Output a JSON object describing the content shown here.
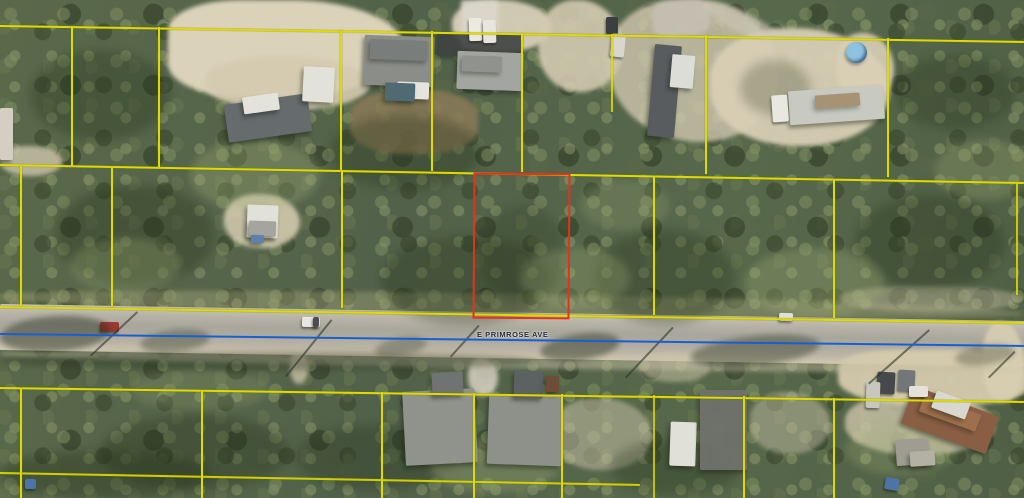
{
  "road": {
    "label": "E PRIMROSE AVE",
    "label_x": 477,
    "label_y": 331,
    "surface": {
      "x": 0,
      "y": 304,
      "w": 1040,
      "h": 46,
      "rot": 0.95
    },
    "centerline": {
      "x1": 0,
      "y1": 333,
      "x2": 1024,
      "y2": 345,
      "t": 2.4,
      "color": "#1a5fd0"
    }
  },
  "overlay": {
    "parcel_line_color": "#dedb04",
    "highlight_color": "#e8301a",
    "highlight_parcel": {
      "x": 473,
      "y": 173,
      "w": 93,
      "h": 142,
      "rot": 0.4
    },
    "parcel_lines": [
      {
        "x1": 0,
        "y1": 25,
        "x2": 1024,
        "y2": 41
      },
      {
        "x1": 0,
        "y1": 164,
        "x2": 1024,
        "y2": 182
      },
      {
        "x1": 0,
        "y1": 306,
        "x2": 1024,
        "y2": 322
      },
      {
        "x1": 0,
        "y1": 387,
        "x2": 1024,
        "y2": 401
      },
      {
        "x1": 0,
        "y1": 472,
        "x2": 640,
        "y2": 484,
        "op": 0.9
      },
      {
        "x1": 73,
        "y1": 26,
        "x2": 73,
        "y2": 166
      },
      {
        "x1": 160,
        "y1": 27,
        "x2": 160,
        "y2": 167
      },
      {
        "x1": 342,
        "y1": 30,
        "x2": 342,
        "y2": 170
      },
      {
        "x1": 433,
        "y1": 31,
        "x2": 433,
        "y2": 171
      },
      {
        "x1": 523,
        "y1": 33,
        "x2": 523,
        "y2": 172
      },
      {
        "x1": 613,
        "y1": 34,
        "x2": 613,
        "y2": 112,
        "op": 0.85
      },
      {
        "x1": 707,
        "y1": 35,
        "x2": 707,
        "y2": 174
      },
      {
        "x1": 889,
        "y1": 38,
        "x2": 889,
        "y2": 177
      },
      {
        "x1": 22,
        "y1": 166,
        "x2": 22,
        "y2": 306
      },
      {
        "x1": 113,
        "y1": 167,
        "x2": 113,
        "y2": 306
      },
      {
        "x1": 343,
        "y1": 170,
        "x2": 343,
        "y2": 308
      },
      {
        "x1": 655,
        "y1": 176,
        "x2": 655,
        "y2": 315
      },
      {
        "x1": 835,
        "y1": 179,
        "x2": 835,
        "y2": 318
      },
      {
        "x1": 1018,
        "y1": 183,
        "x2": 1018,
        "y2": 295,
        "op": 0.85
      },
      {
        "x1": 22,
        "y1": 388,
        "x2": 22,
        "y2": 498
      },
      {
        "x1": 203,
        "y1": 390,
        "x2": 203,
        "y2": 498
      },
      {
        "x1": 383,
        "y1": 392,
        "x2": 383,
        "y2": 498
      },
      {
        "x1": 475,
        "y1": 393,
        "x2": 475,
        "y2": 498
      },
      {
        "x1": 563,
        "y1": 394,
        "x2": 563,
        "y2": 498
      },
      {
        "x1": 655,
        "y1": 395,
        "x2": 655,
        "y2": 498,
        "op": 0.8
      },
      {
        "x1": 745,
        "y1": 396,
        "x2": 745,
        "y2": 498
      },
      {
        "x1": 835,
        "y1": 398,
        "x2": 835,
        "y2": 498
      }
    ]
  },
  "terrain": {
    "sand": [
      {
        "name": "sand-clearing",
        "x": 168,
        "y": 0,
        "w": 235,
        "h": 98,
        "color": "#dbd2ba",
        "br": "35% 55% 60% 40%"
      },
      {
        "name": "sand-clearing",
        "x": 205,
        "y": 56,
        "w": 165,
        "h": 54,
        "color": "#d5cbb1",
        "op": 0.9
      },
      {
        "name": "sand-clearing",
        "x": 452,
        "y": 0,
        "w": 100,
        "h": 52,
        "color": "#d7cfb8",
        "op": 0.95
      },
      {
        "name": "sand-clearing",
        "x": 538,
        "y": 0,
        "w": 85,
        "h": 92,
        "color": "#d3cab0",
        "op": 0.9
      },
      {
        "name": "sand-clearing",
        "x": 608,
        "y": 0,
        "w": 170,
        "h": 142,
        "color": "#cfc7ae",
        "op": 0.8,
        "br": "40% 50% 45% 55%"
      },
      {
        "name": "sand-clearing",
        "x": 710,
        "y": 28,
        "w": 180,
        "h": 118,
        "color": "#d8cfb5",
        "op": 0.95
      },
      {
        "name": "sand-clearing",
        "x": 836,
        "y": 33,
        "w": 58,
        "h": 70,
        "color": "#d9d0b6",
        "op": 0.9
      },
      {
        "name": "sand-trail",
        "x": 0,
        "y": 146,
        "w": 62,
        "h": 30,
        "color": "#cec5ab",
        "op": 0.8
      },
      {
        "name": "sand-clearing",
        "x": 224,
        "y": 194,
        "w": 76,
        "h": 54,
        "color": "#d2c9ae",
        "op": 0.9
      },
      {
        "name": "sand-clearing",
        "x": 838,
        "y": 350,
        "w": 190,
        "h": 55,
        "color": "#d5cbae",
        "op": 0.95,
        "br": "30% 40% 35% 45%"
      },
      {
        "name": "sand-clearing",
        "x": 982,
        "y": 322,
        "w": 42,
        "h": 80,
        "color": "#d8cfb3",
        "op": 0.9
      },
      {
        "name": "sand-clearing",
        "x": 552,
        "y": 398,
        "w": 100,
        "h": 72,
        "color": "#cfc7ac",
        "op": 0.5
      },
      {
        "name": "sand-clearing",
        "x": 750,
        "y": 392,
        "w": 80,
        "h": 62,
        "color": "#ccc4a9",
        "op": 0.45
      },
      {
        "name": "sand-clearing",
        "x": 640,
        "y": 352,
        "w": 70,
        "h": 30,
        "color": "#cdc5aa",
        "op": 0.5
      },
      {
        "name": "sand-clearing",
        "x": 845,
        "y": 393,
        "w": 150,
        "h": 62,
        "color": "#d4cbb0",
        "op": 0.75
      },
      {
        "name": "driveway",
        "x": 290,
        "y": 350,
        "w": 18,
        "h": 34,
        "color": "#cfc6ab",
        "op": 0.75
      },
      {
        "name": "driveway",
        "x": 468,
        "y": 358,
        "w": 30,
        "h": 38,
        "color": "#d6d0c2",
        "op": 0.85
      },
      {
        "name": "driveway",
        "x": 461,
        "y": 0,
        "w": 37,
        "h": 48,
        "color": "#dcd7cb",
        "op": 0.95,
        "br": "8%"
      },
      {
        "name": "dirt-yard",
        "x": 350,
        "y": 90,
        "w": 128,
        "h": 64,
        "color": "#8d7b58",
        "op": 0.8,
        "br": "40%"
      },
      {
        "name": "road-shoulder",
        "x": 0,
        "y": 286,
        "w": 1024,
        "h": 22,
        "color": "#aca97f",
        "op": 0.38,
        "rot": 0.9,
        "origin0": true
      },
      {
        "name": "road-shoulder",
        "x": 0,
        "y": 348,
        "w": 1024,
        "h": 12,
        "color": "#c8bfa4",
        "op": 0.5,
        "rot": 0.9,
        "origin0": true
      },
      {
        "name": "gravel-path",
        "x": 652,
        "y": 0,
        "w": 58,
        "h": 36,
        "color": "#c6c0b4",
        "op": 0.9,
        "rot": -6,
        "br": "30%"
      },
      {
        "name": "gravel-path",
        "x": 700,
        "y": 12,
        "w": 85,
        "h": 20,
        "color": "#cfc8b8",
        "op": 0.6,
        "rot": 25
      },
      {
        "name": "grass-strip",
        "x": 840,
        "y": 286,
        "w": 184,
        "h": 26,
        "color": "#b7b194",
        "op": 0.5
      }
    ],
    "canopy_dark": [
      {
        "x": 30,
        "y": 50,
        "w": 140,
        "h": 90,
        "op": 0.3
      },
      {
        "x": 330,
        "y": 115,
        "w": 150,
        "h": 75,
        "op": 0.3
      },
      {
        "x": 55,
        "y": 185,
        "w": 160,
        "h": 100,
        "op": 0.32
      },
      {
        "x": 380,
        "y": 235,
        "w": 170,
        "h": 90,
        "op": 0.3
      },
      {
        "x": 595,
        "y": 230,
        "w": 140,
        "h": 95,
        "op": 0.3
      },
      {
        "x": 855,
        "y": 195,
        "w": 150,
        "h": 95,
        "op": 0.3
      },
      {
        "x": 100,
        "y": 415,
        "w": 190,
        "h": 75,
        "op": 0.32
      },
      {
        "x": 295,
        "y": 425,
        "w": 160,
        "h": 65,
        "op": 0.3
      },
      {
        "x": 610,
        "y": 440,
        "w": 130,
        "h": 55,
        "op": 0.3
      },
      {
        "x": 895,
        "y": 55,
        "w": 120,
        "h": 75,
        "op": 0.28
      },
      {
        "x": 0,
        "y": 450,
        "w": 210,
        "h": 48,
        "op": 0.35
      },
      {
        "x": 480,
        "y": 205,
        "w": 85,
        "h": 100,
        "op": 0.22
      },
      {
        "x": 740,
        "y": 60,
        "w": 70,
        "h": 55,
        "op": 0.25
      }
    ],
    "canopy_light": [
      {
        "x": 190,
        "y": 140,
        "w": 130,
        "h": 70,
        "op": 0.3
      },
      {
        "x": 520,
        "y": 248,
        "w": 110,
        "h": 60,
        "op": 0.28
      },
      {
        "x": 745,
        "y": 248,
        "w": 140,
        "h": 70,
        "op": 0.3
      },
      {
        "x": 935,
        "y": 140,
        "w": 100,
        "h": 60,
        "op": 0.28
      },
      {
        "x": 70,
        "y": 238,
        "w": 110,
        "h": 55,
        "op": 0.25
      },
      {
        "x": 430,
        "y": 438,
        "w": 130,
        "h": 55,
        "op": 0.3
      },
      {
        "x": 845,
        "y": 425,
        "w": 110,
        "h": 50,
        "op": 0.25
      },
      {
        "x": 130,
        "y": 370,
        "w": 140,
        "h": 40,
        "op": 0.2
      },
      {
        "x": 580,
        "y": 180,
        "w": 90,
        "h": 50,
        "op": 0.22
      }
    ],
    "streaks": [
      {
        "x": 0,
        "y": 316,
        "w": 110,
        "h": 36,
        "rot": -4,
        "op": 0.45
      },
      {
        "x": 140,
        "y": 330,
        "w": 70,
        "h": 22,
        "rot": -6,
        "op": 0.35
      },
      {
        "x": 375,
        "y": 338,
        "w": 52,
        "h": 18,
        "rot": -10,
        "op": 0.3
      },
      {
        "x": 540,
        "y": 334,
        "w": 80,
        "h": 26,
        "rot": -8,
        "op": 0.45
      },
      {
        "x": 690,
        "y": 336,
        "w": 130,
        "h": 30,
        "rot": -6,
        "op": 0.4
      },
      {
        "x": 0,
        "y": 352,
        "w": 540,
        "h": 18,
        "rot": 0,
        "op": 0.35
      },
      {
        "x": 955,
        "y": 345,
        "w": 60,
        "h": 20,
        "rot": -8,
        "op": 0.3
      }
    ],
    "pole_shadows": [
      {
        "x1": 90,
        "y1": 355,
        "x2": 137,
        "y2": 311
      },
      {
        "x1": 285,
        "y1": 376,
        "x2": 331,
        "y2": 319
      },
      {
        "x1": 450,
        "y1": 356,
        "x2": 478,
        "y2": 325
      },
      {
        "x1": 625,
        "y1": 377,
        "x2": 672,
        "y2": 327
      },
      {
        "x1": 868,
        "y1": 383,
        "x2": 929,
        "y2": 329
      },
      {
        "x1": 988,
        "y1": 377,
        "x2": 1014,
        "y2": 351
      }
    ]
  },
  "structures": [
    {
      "name": "shed-roof",
      "x": 0,
      "y": 108,
      "w": 13,
      "h": 52,
      "color": "#d4cfc2"
    },
    {
      "name": "house-roof",
      "x": 226,
      "y": 99,
      "w": 84,
      "h": 38,
      "color": "#666b6d",
      "rot": -8
    },
    {
      "name": "shed-roof",
      "x": 243,
      "y": 95,
      "w": 36,
      "h": 17,
      "color": "#e4e3db",
      "rot": -8
    },
    {
      "name": "shed-roof",
      "x": 303,
      "y": 67,
      "w": 31,
      "h": 35,
      "color": "#e3e2da",
      "rot": 3
    },
    {
      "name": "house-roof",
      "x": 364,
      "y": 36,
      "w": 70,
      "h": 50,
      "color": "#8b8e88",
      "rot": 2
    },
    {
      "name": "roof-ridge",
      "x": 370,
      "y": 40,
      "w": 58,
      "h": 20,
      "color": "#75797a",
      "rot": 2,
      "op": 0.8
    },
    {
      "name": "patio",
      "x": 397,
      "y": 82,
      "w": 32,
      "h": 17,
      "color": "#e6e5dd",
      "rot": 2
    },
    {
      "name": "roof-panel",
      "x": 385,
      "y": 83,
      "w": 30,
      "h": 18,
      "color": "#4f6a73",
      "rot": 2
    },
    {
      "name": "paved-pad",
      "x": 437,
      "y": 33,
      "w": 86,
      "h": 23,
      "color": "#3e4240",
      "rot": 1,
      "op": 0.9
    },
    {
      "name": "house-roof",
      "x": 457,
      "y": 52,
      "w": 66,
      "h": 38,
      "color": "#a3a6a0",
      "rot": 2
    },
    {
      "name": "roof-ridge",
      "x": 462,
      "y": 56,
      "w": 40,
      "h": 16,
      "color": "#8b8e89",
      "rot": 2,
      "op": 0.8
    },
    {
      "name": "house-roof",
      "x": 651,
      "y": 45,
      "w": 27,
      "h": 92,
      "color": "#585c5e",
      "rot": 5
    },
    {
      "name": "shed-roof",
      "x": 671,
      "y": 55,
      "w": 23,
      "h": 33,
      "color": "#dcddd6",
      "rot": 5
    },
    {
      "name": "mobile-home",
      "x": 789,
      "y": 88,
      "w": 95,
      "h": 34,
      "color": "#c8c9c0",
      "rot": -4
    },
    {
      "name": "rust-patch",
      "x": 815,
      "y": 94,
      "w": 45,
      "h": 13,
      "color": "#9a7c55",
      "rot": -4,
      "op": 0.7
    },
    {
      "name": "pool",
      "cls": "pool",
      "x": 846,
      "y": 42,
      "w": 21,
      "h": 21,
      "color": "#8fc2e0"
    },
    {
      "name": "shed-roof",
      "x": 247,
      "y": 205,
      "w": 31,
      "h": 33,
      "color": "#e2e1d9",
      "rot": 2
    },
    {
      "name": "roof-panel",
      "x": 249,
      "y": 221,
      "w": 27,
      "h": 15,
      "color": "#a5a59f",
      "rot": 2
    },
    {
      "name": "blue-tarp",
      "x": 251,
      "y": 235,
      "w": 13,
      "h": 8,
      "color": "#5d81ab",
      "rot": 2
    },
    {
      "name": "house-roof",
      "x": 404,
      "y": 390,
      "w": 72,
      "h": 74,
      "color": "#90938c",
      "rot": -3
    },
    {
      "name": "roof-gable",
      "x": 432,
      "y": 372,
      "w": 31,
      "h": 23,
      "color": "#6f7473",
      "rot": -3
    },
    {
      "name": "house-roof",
      "x": 488,
      "y": 395,
      "w": 74,
      "h": 70,
      "color": "#8e908a",
      "rot": 2
    },
    {
      "name": "roof-gable",
      "x": 514,
      "y": 371,
      "w": 29,
      "h": 27,
      "color": "#5c6162",
      "rot": 2
    },
    {
      "name": "shed-roof",
      "x": 546,
      "y": 376,
      "w": 13,
      "h": 16,
      "color": "#6e4c3a",
      "rot": 2
    },
    {
      "name": "shed-roof",
      "x": 670,
      "y": 422,
      "w": 26,
      "h": 44,
      "color": "#e1e0d8",
      "rot": 2
    },
    {
      "name": "mobile-home",
      "x": 700,
      "y": 390,
      "w": 47,
      "h": 80,
      "color": "#6f726b",
      "op": 0.95
    },
    {
      "name": "trailer",
      "x": 905,
      "y": 400,
      "w": 90,
      "h": 40,
      "color": "#8a5e43",
      "rot": 20
    },
    {
      "name": "rust-patch",
      "x": 920,
      "y": 404,
      "w": 60,
      "h": 18,
      "color": "#a3744f",
      "rot": 20,
      "op": 0.8
    },
    {
      "name": "trailer-cab",
      "x": 933,
      "y": 396,
      "w": 36,
      "h": 18,
      "color": "#d9d8cf",
      "rot": 20
    },
    {
      "name": "shed-roof",
      "x": 896,
      "y": 439,
      "w": 33,
      "h": 26,
      "color": "#9f9c91",
      "rot": -4
    },
    {
      "name": "shed-roof",
      "x": 910,
      "y": 451,
      "w": 25,
      "h": 15,
      "color": "#b3b0a4",
      "rot": -4
    }
  ],
  "vehicles": [
    {
      "name": "car",
      "x": 469,
      "y": 18,
      "w": 13,
      "h": 23,
      "color": "#ebe9e1",
      "rot": -2
    },
    {
      "name": "car",
      "x": 483,
      "y": 20,
      "w": 13,
      "h": 23,
      "color": "#e7e5dd",
      "rot": -2
    },
    {
      "name": "car",
      "x": 606,
      "y": 17,
      "w": 12,
      "h": 17,
      "color": "#3c3f42"
    },
    {
      "name": "van",
      "x": 611,
      "y": 34,
      "w": 14,
      "h": 23,
      "color": "#d8d7cf",
      "rot": 6
    },
    {
      "name": "car",
      "x": 772,
      "y": 95,
      "w": 16,
      "h": 27,
      "color": "#e9e8e0",
      "rot": -4
    },
    {
      "name": "car-on-road",
      "x": 100,
      "y": 322,
      "w": 19,
      "h": 10,
      "color": "#993832",
      "rot": 1
    },
    {
      "name": "car-on-road",
      "x": 302,
      "y": 317,
      "w": 18,
      "h": 10,
      "color": "#e8e6de",
      "rot": 1
    },
    {
      "name": "car-windshield",
      "x": 313,
      "y": 317,
      "w": 6,
      "h": 10,
      "color": "#4a4e52",
      "rot": 1
    },
    {
      "name": "car-on-road",
      "x": 779,
      "y": 313,
      "w": 14,
      "h": 8,
      "color": "#dfe0d8",
      "rot": 2
    },
    {
      "name": "van",
      "x": 877,
      "y": 372,
      "w": 18,
      "h": 22,
      "color": "#46494b",
      "rot": 3
    },
    {
      "name": "car",
      "x": 898,
      "y": 370,
      "w": 17,
      "h": 21,
      "color": "#73777a",
      "rot": 3
    },
    {
      "name": "truck",
      "x": 909,
      "y": 386,
      "w": 19,
      "h": 11,
      "color": "#e4e2d9"
    },
    {
      "name": "rv",
      "x": 866,
      "y": 382,
      "w": 14,
      "h": 26,
      "color": "#c8c7be",
      "rot": 2
    },
    {
      "name": "blue-object",
      "x": 885,
      "y": 478,
      "w": 14,
      "h": 12,
      "color": "#4e73a7",
      "rot": 10
    },
    {
      "name": "blue-object",
      "x": 25,
      "y": 479,
      "w": 11,
      "h": 10,
      "color": "#4e73a7"
    }
  ]
}
